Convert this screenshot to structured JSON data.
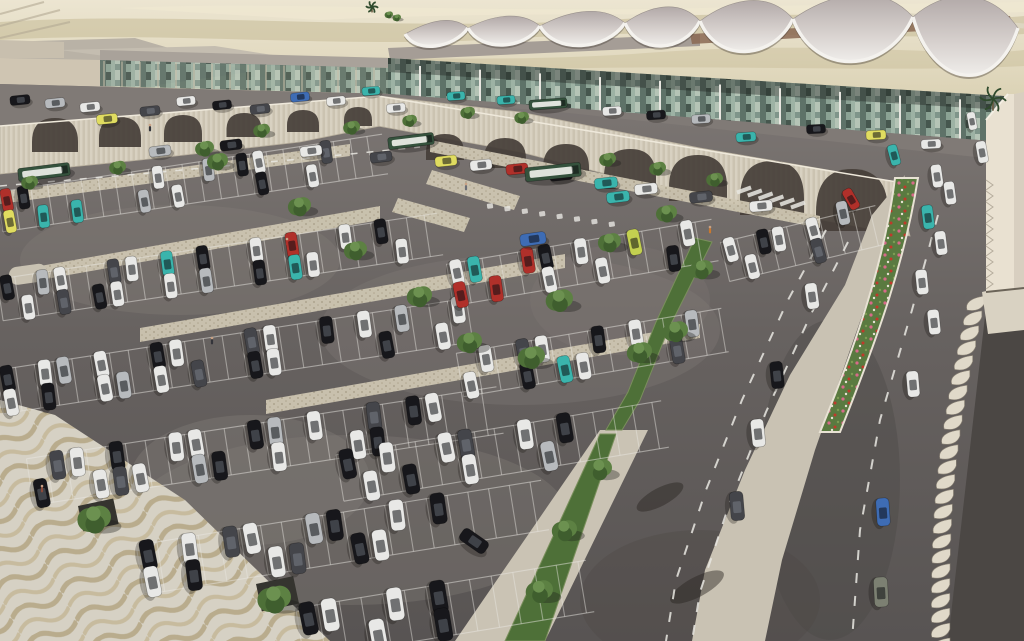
{
  "scene": {
    "kind": "aerial-architectural-rendering",
    "subject": "airport terminal with scalloped canopy roof and large surface parking lot"
  },
  "palette": {
    "desert_light": "#e9e2cd",
    "desert_mid": "#d5cbaa",
    "desert_streak": "#bfb48c",
    "asphalt_top": "#7d7774",
    "asphalt_bottom": "#585453",
    "upper_road": "#807a76",
    "wall": "#d8d1c1",
    "wall_rib": "#cbc3b1",
    "arch_dark": "#453e38",
    "concrete": "#c9c2b3",
    "plaza": "#d6d1c4",
    "plaza_wave": "#b9ac8d",
    "canopy_top": "#b6adab",
    "canopy_rim": "#f4f2ee",
    "ridge_brown": "#8a6852",
    "glass_dark": "#46574e",
    "glass_mid": "#7f958a",
    "glass_light": "#9db2a4",
    "green_dark": "#3f5e2e",
    "green_mid": "#4e7038",
    "green_light": "#5d8143",
    "flower_bed": "#5a7a40",
    "louver": "#e0d9c9",
    "building_face": "#e9e1d1",
    "bus_green": "#35523d",
    "marking_white": "#e9e7e2"
  },
  "car_colors": {
    "w": "#e8e8e6",
    "k": "#17171b",
    "g": "#44454a",
    "s": "#b7babd",
    "r": "#b0302a",
    "t": "#3ab4ac",
    "y": "#e0dc60",
    "b": "#3e6cb4",
    "l": "#c3d050",
    "o": "#7c8072"
  },
  "terminal": {
    "canopy_cusps": [
      [
        405,
        34
      ],
      [
        468,
        28
      ],
      [
        540,
        26
      ],
      [
        625,
        23
      ],
      [
        700,
        21
      ],
      [
        793,
        19
      ],
      [
        913,
        17
      ],
      [
        1018,
        28
      ]
    ],
    "canopy_dip": [
      20,
      24,
      28,
      32,
      42,
      58,
      70
    ],
    "canopy_height": [
      18,
      20,
      24,
      28,
      36,
      44,
      50
    ],
    "facade": [
      [
        388,
        58
      ],
      [
        1004,
        96
      ],
      [
        1004,
        144
      ],
      [
        388,
        96
      ]
    ],
    "left_glass": [
      [
        100,
        60
      ],
      [
        392,
        68
      ],
      [
        392,
        94
      ],
      [
        100,
        86
      ]
    ],
    "column_count": 10
  },
  "wall": {
    "left_wing": [
      [
        0,
        126
      ],
      [
        380,
        96
      ],
      [
        380,
        126
      ],
      [
        300,
        142
      ],
      [
        140,
        160
      ],
      [
        0,
        174
      ]
    ],
    "right_wing": [
      [
        378,
        96
      ],
      [
        520,
        112
      ],
      [
        700,
        148
      ],
      [
        897,
        182
      ],
      [
        910,
        236
      ],
      [
        700,
        198
      ],
      [
        520,
        152
      ],
      [
        378,
        126
      ]
    ],
    "arches_left": [
      [
        55,
        152,
        46,
        34
      ],
      [
        120,
        147,
        42,
        30
      ],
      [
        183,
        142,
        38,
        27
      ],
      [
        244,
        137,
        35,
        24
      ],
      [
        303,
        132,
        32,
        22
      ],
      [
        358,
        126,
        28,
        19
      ]
    ],
    "arches_right": [
      [
        445,
        160,
        38,
        26
      ],
      [
        505,
        168,
        42,
        30
      ],
      [
        566,
        178,
        46,
        34
      ],
      [
        630,
        189,
        52,
        40
      ],
      [
        698,
        201,
        58,
        46
      ],
      [
        772,
        215,
        64,
        54
      ],
      [
        852,
        231,
        72,
        62
      ]
    ]
  },
  "ground": {
    "outline": [
      [
        0,
        84
      ],
      [
        390,
        94
      ],
      [
        1004,
        142
      ],
      [
        1024,
        150
      ],
      [
        1024,
        641
      ],
      [
        0,
        641
      ]
    ],
    "upper_road": [
      [
        0,
        84
      ],
      [
        390,
        94
      ],
      [
        1004,
        142
      ],
      [
        1004,
        160
      ],
      [
        560,
        112
      ],
      [
        398,
        99
      ],
      [
        0,
        132
      ]
    ],
    "light_patches": [
      [
        180,
        260,
        160,
        55,
        0.35
      ],
      [
        520,
        330,
        200,
        75,
        0.3
      ],
      [
        350,
        520,
        220,
        85,
        0.35
      ],
      [
        250,
        480,
        120,
        65,
        0.4
      ],
      [
        620,
        300,
        90,
        55,
        0.25
      ]
    ],
    "dark_patches": [
      [
        830,
        480,
        70,
        160,
        0.4
      ],
      [
        700,
        600,
        120,
        70,
        0.35
      ]
    ]
  },
  "surfaces": {
    "median": [
      [
        872,
        215
      ],
      [
        845,
        285
      ],
      [
        790,
        375
      ],
      [
        745,
        470
      ],
      [
        705,
        570
      ],
      [
        692,
        641
      ],
      [
        765,
        641
      ],
      [
        782,
        560
      ],
      [
        815,
        450
      ],
      [
        850,
        350
      ],
      [
        885,
        250
      ],
      [
        905,
        175
      ]
    ],
    "bottom_walk": [
      [
        455,
        641
      ],
      [
        545,
        641
      ],
      [
        648,
        430
      ],
      [
        600,
        430
      ]
    ],
    "plaza": [
      [
        0,
        400
      ],
      [
        55,
        415
      ],
      [
        185,
        500
      ],
      [
        330,
        641
      ],
      [
        0,
        641
      ]
    ],
    "walkways": [
      [
        [
          40,
          280
        ],
        [
          380,
          220
        ],
        [
          380,
          206
        ],
        [
          40,
          266
        ]
      ],
      [
        [
          140,
          342
        ],
        [
          565,
          268
        ],
        [
          565,
          254
        ],
        [
          140,
          328
        ]
      ],
      [
        [
          266,
          414
        ],
        [
          700,
          338
        ],
        [
          700,
          324
        ],
        [
          266,
          400
        ]
      ],
      [
        [
          0,
          204
        ],
        [
          350,
          156
        ],
        [
          350,
          144
        ],
        [
          0,
          192
        ]
      ],
      [
        [
          430,
          152
        ],
        [
          820,
          228
        ],
        [
          820,
          216
        ],
        [
          430,
          140
        ]
      ],
      [
        [
          432,
          170
        ],
        [
          520,
          196
        ],
        [
          514,
          210
        ],
        [
          426,
          184
        ]
      ],
      [
        [
          398,
          198
        ],
        [
          470,
          218
        ],
        [
          464,
          232
        ],
        [
          392,
          212
        ]
      ]
    ],
    "island": [
      8,
      268,
      38,
      18
    ],
    "planters": [
      [
        78,
        506,
        36,
        26
      ],
      [
        256,
        584,
        38,
        28
      ]
    ]
  },
  "greens": {
    "strip_a": [
      [
        695,
        238
      ],
      [
        712,
        242
      ],
      [
        668,
        330
      ],
      [
        640,
        400
      ],
      [
        622,
        430
      ],
      [
        606,
        430
      ],
      [
        628,
        392
      ],
      [
        656,
        322
      ]
    ],
    "strip_b": [
      [
        600,
        434
      ],
      [
        616,
        434
      ],
      [
        545,
        641
      ],
      [
        505,
        641
      ]
    ],
    "flower_bed": {
      "top": [
        895,
        178,
        918,
        178
      ],
      "bottom": [
        820,
        432,
        840,
        432
      ]
    }
  },
  "parking_bands": [
    {
      "line": [
        0,
        212,
        385,
        154
      ],
      "tick": 17,
      "h": 40,
      "len": 23,
      "top": "rk.......w..s.kw...g..",
      "bot": "y.t.t...s.w....k..w..."
    },
    {
      "line": [
        0,
        300,
        440,
        234
      ],
      "tick": 18,
      "h": 42,
      "len": 25,
      "top": "k.sw..gw.t.k..w.r..w.k..",
      "bot": ".w.g.kw..w.s..k.tw....w."
    },
    {
      "line": [
        0,
        392,
        470,
        320
      ],
      "tick": 19,
      "h": 44,
      "len": 27,
      "top": "k.ws.w..kw...gw..k.w.s..w",
      "bot": "w.k..ws.w.g..kw.....k..w."
    },
    {
      "line": [
        30,
        482,
        500,
        410
      ],
      "tick": 20,
      "h": 47,
      "len": 29,
      "top": ".gw.k..ww..ks.w..g.kw..",
      "bot": "k..wgw..sk..w...wk....."
    },
    {
      "line": [
        140,
        570,
        545,
        505
      ],
      "tick": 21,
      "h": 50,
      "len": 31,
      "top": "k.w.gw..sk..w.k....",
      "bot": "w.k...wg..kw......."
    },
    {
      "line": [
        300,
        634,
        590,
        586
      ],
      "tick": 22,
      "h": 52,
      "len": 33,
      "top": "kw..w.k......",
      "bot": "...w..k......"
    },
    {
      "line": [
        450,
        285,
        715,
        240
      ],
      "tick": 18,
      "h": 42,
      "len": 26,
      "top": "wt..rk.w..l..w",
      "bot": "r.r..w..w...k."
    },
    {
      "line": [
        460,
        375,
        725,
        330
      ],
      "tick": 19,
      "h": 44,
      "len": 27,
      "top": ".w.gw..k.w..s.",
      "bot": "w..k.tw....g.."
    },
    {
      "line": [
        340,
        478,
        665,
        424
      ],
      "tick": 20,
      "h": 47,
      "len": 30,
      "top": "k.w..wg..w.k....",
      "bot": ".w.k..w...s....."
    },
    {
      "line": [
        725,
        262,
        880,
        225
      ],
      "tick": 17,
      "h": 40,
      "len": 25,
      "top": "w.k..w...",
      "bot": ".w...g..."
    }
  ],
  "driving_cars": [
    [
      20,
      100,
      -6,
      "k",
      20
    ],
    [
      55,
      103,
      -6,
      "s",
      20
    ],
    [
      90,
      107,
      -6,
      "w",
      20
    ],
    [
      107,
      119,
      -6,
      "y",
      21
    ],
    [
      150,
      111,
      -6,
      "g",
      20
    ],
    [
      186,
      101,
      -6,
      "w",
      19
    ],
    [
      222,
      105,
      -6,
      "k",
      19
    ],
    [
      260,
      109,
      -6,
      "g",
      20
    ],
    [
      300,
      97,
      -6,
      "b",
      19
    ],
    [
      336,
      101,
      -6,
      "w",
      19
    ],
    [
      371,
      91,
      -5,
      "t",
      18
    ],
    [
      396,
      108,
      -5,
      "w",
      19
    ],
    [
      456,
      96,
      -4,
      "t",
      18
    ],
    [
      506,
      100,
      -4,
      "t",
      18
    ],
    [
      612,
      111,
      -4,
      "w",
      19
    ],
    [
      656,
      115,
      -4,
      "k",
      19
    ],
    [
      701,
      119,
      -4,
      "s",
      19
    ],
    [
      746,
      137,
      -4,
      "t",
      20
    ],
    [
      816,
      129,
      -3,
      "k",
      19
    ],
    [
      876,
      135,
      -3,
      "y",
      20
    ],
    [
      931,
      144,
      -3,
      "w",
      20
    ],
    [
      972,
      121,
      80,
      "w",
      18
    ],
    [
      160,
      151,
      -7,
      "s",
      22
    ],
    [
      231,
      145,
      -7,
      "k",
      22
    ],
    [
      311,
      151,
      -7,
      "w",
      22
    ],
    [
      381,
      157,
      -7,
      "g",
      22
    ],
    [
      446,
      161,
      -6,
      "y",
      22
    ],
    [
      481,
      165,
      -6,
      "w",
      22
    ],
    [
      517,
      169,
      -6,
      "r",
      22
    ],
    [
      561,
      175,
      -6,
      "k",
      23
    ],
    [
      606,
      183,
      -6,
      "t",
      23
    ],
    [
      646,
      189,
      -6,
      "w",
      23
    ],
    [
      701,
      197,
      -6,
      "g",
      23
    ],
    [
      761,
      206,
      -5,
      "w",
      23
    ],
    [
      851,
      199,
      60,
      "r",
      22
    ],
    [
      894,
      155,
      75,
      "t",
      21
    ],
    [
      843,
      213,
      78,
      "s",
      24
    ],
    [
      779,
      239,
      80,
      "w",
      25
    ],
    [
      812,
      296,
      82,
      "w",
      26
    ],
    [
      777,
      375,
      84,
      "k",
      27
    ],
    [
      758,
      433,
      84,
      "w",
      28
    ],
    [
      737,
      506,
      85,
      "g",
      29
    ],
    [
      474,
      541,
      35,
      "k",
      30
    ],
    [
      982,
      152,
      80,
      "w",
      22
    ],
    [
      937,
      176,
      82,
      "w",
      23
    ],
    [
      950,
      193,
      82,
      "w",
      23
    ],
    [
      928,
      217,
      83,
      "t",
      24
    ],
    [
      941,
      243,
      83,
      "w",
      24
    ],
    [
      922,
      282,
      84,
      "w",
      25
    ],
    [
      934,
      322,
      84,
      "w",
      25
    ],
    [
      913,
      384,
      85,
      "w",
      26
    ],
    [
      883,
      512,
      86,
      "b",
      28
    ],
    [
      881,
      592,
      87,
      "o",
      30
    ],
    [
      533,
      239,
      -8,
      "b",
      26
    ],
    [
      618,
      197,
      -7,
      "t",
      23
    ]
  ],
  "buses": [
    [
      44,
      172,
      -7,
      52,
      13
    ],
    [
      411,
      141,
      -7,
      46,
      12
    ],
    [
      553,
      172,
      -6,
      56,
      14
    ],
    [
      548,
      104,
      -4,
      38,
      10
    ]
  ],
  "trees": [
    [
      30,
      183,
      8
    ],
    [
      118,
      168,
      8
    ],
    [
      205,
      149,
      9
    ],
    [
      262,
      131,
      8
    ],
    [
      352,
      128,
      8
    ],
    [
      410,
      121,
      7
    ],
    [
      468,
      113,
      7
    ],
    [
      522,
      118,
      7
    ],
    [
      218,
      162,
      10
    ],
    [
      300,
      207,
      11
    ],
    [
      356,
      251,
      11
    ],
    [
      420,
      297,
      12
    ],
    [
      470,
      343,
      12
    ],
    [
      532,
      358,
      13
    ],
    [
      560,
      301,
      13
    ],
    [
      610,
      243,
      11
    ],
    [
      667,
      214,
      10
    ],
    [
      702,
      270,
      11
    ],
    [
      676,
      332,
      12
    ],
    [
      640,
      353,
      12
    ],
    [
      600,
      470,
      12
    ],
    [
      565,
      531,
      12
    ],
    [
      540,
      592,
      13
    ],
    [
      95,
      520,
      16
    ],
    [
      275,
      600,
      16
    ],
    [
      608,
      160,
      8
    ],
    [
      658,
      169,
      8
    ],
    [
      715,
      180,
      8
    ],
    [
      389,
      15,
      4
    ],
    [
      397,
      18,
      4
    ]
  ],
  "palms": [
    [
      993,
      99,
      13
    ],
    [
      372,
      7,
      6
    ]
  ],
  "palm_shadows": [
    [
      660,
      497,
      26,
      9
    ],
    [
      697,
      587,
      30,
      10
    ]
  ],
  "people": [
    [
      42,
      490,
      "#8a4a3a"
    ],
    [
      212,
      342,
      "#33343a"
    ],
    [
      287,
      243,
      "#b0302a"
    ],
    [
      710,
      231,
      "#c9782f"
    ],
    [
      466,
      188,
      "#6b6e75"
    ],
    [
      150,
      129,
      "#33343a"
    ]
  ],
  "markings": {
    "dashes": [
      {
        "pts": [
          [
            0,
            186
          ],
          [
            150,
            173
          ],
          [
            300,
            159
          ],
          [
            420,
            147
          ]
        ],
        "w": 1.5,
        "dash": "7 9"
      },
      {
        "pts": [
          [
            826,
            230
          ],
          [
            788,
            300
          ],
          [
            742,
            400
          ],
          [
            706,
            490
          ],
          [
            676,
            580
          ],
          [
            666,
            641
          ]
        ],
        "w": 2,
        "dash": "10 13"
      },
      {
        "pts": [
          [
            848,
            242
          ],
          [
            812,
            312
          ],
          [
            766,
            412
          ],
          [
            730,
            502
          ],
          [
            700,
            592
          ],
          [
            692,
            641
          ]
        ],
        "w": 2,
        "dash": "10 13"
      },
      {
        "pts": [
          [
            938,
            215
          ],
          [
            912,
            310
          ],
          [
            880,
            420
          ],
          [
            860,
            530
          ],
          [
            852,
            641
          ]
        ],
        "w": 2,
        "dash": "10 13"
      }
    ],
    "zebra": {
      "start": [
        744,
        190
      ],
      "step": [
        10.8,
        3.0
      ],
      "count": 6
    },
    "glyphs": {
      "start": [
        490,
        206
      ],
      "step": [
        17.4,
        2.6
      ],
      "count": 8
    }
  },
  "structures": {
    "louver_back": [
      [
        988,
        290
      ],
      [
        1024,
        286
      ],
      [
        1024,
        641
      ],
      [
        948,
        641
      ]
    ],
    "louver_fins": {
      "from": [
        985,
        296
      ],
      "to": [
        950,
        638
      ],
      "count": 24
    },
    "building_left_face": [
      [
        986,
        120
      ],
      [
        1008,
        94
      ],
      [
        1014,
        94
      ],
      [
        1014,
        290
      ],
      [
        986,
        292
      ]
    ],
    "building_right_face": [
      [
        1014,
        94
      ],
      [
        1024,
        92
      ],
      [
        1024,
        288
      ],
      [
        1014,
        290
      ]
    ],
    "building_ribs": {
      "x": 986,
      "y0": 180,
      "step": 11,
      "count": 10
    },
    "louver_top": [
      [
        982,
        292
      ],
      [
        1024,
        282
      ],
      [
        1024,
        330
      ],
      [
        988,
        334
      ]
    ]
  }
}
